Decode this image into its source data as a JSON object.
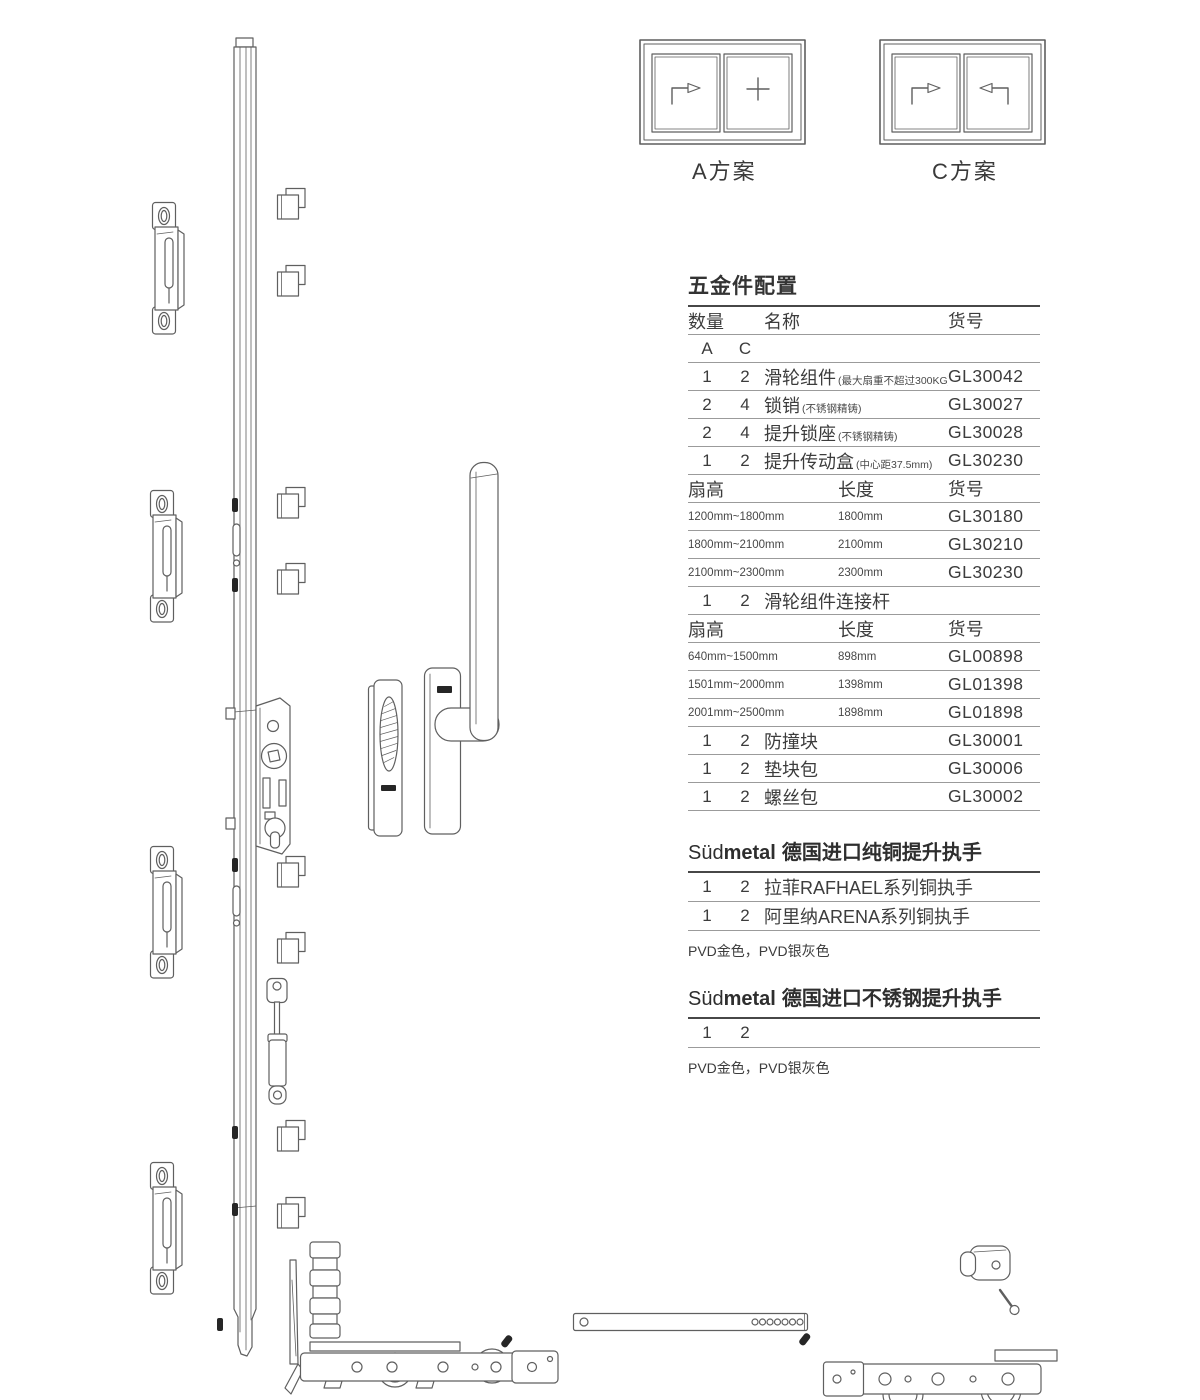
{
  "plans": {
    "a_label": "A方案",
    "c_label": "C方案"
  },
  "hardware_table": {
    "title": "五金件配置",
    "headers": {
      "qty": "数量",
      "name": "名称",
      "code": "货号"
    },
    "variant_a": "A",
    "variant_c": "C",
    "rows": [
      {
        "a": "1",
        "c": "2",
        "name": "滑轮组件",
        "note": "(最大扇重不超过300KG)",
        "code": "GL30042"
      },
      {
        "a": "2",
        "c": "4",
        "name": "锁销",
        "note": "(不锈钢精铸)",
        "code": "GL30027"
      },
      {
        "a": "2",
        "c": "4",
        "name": "提升锁座",
        "note": "(不锈钢精铸)",
        "code": "GL30028"
      },
      {
        "a": "1",
        "c": "2",
        "name": "提升传动盒",
        "note": "(中心距37.5mm)",
        "code": "GL30230"
      }
    ],
    "size_header_1": {
      "fan": "扇高",
      "len": "长度",
      "code": "货号"
    },
    "size_rows_1": [
      {
        "fan": "1200mm~1800mm",
        "len": "1800mm",
        "code": "GL30180"
      },
      {
        "fan": "1800mm~2100mm",
        "len": "2100mm",
        "code": "GL30210"
      },
      {
        "fan": "2100mm~2300mm",
        "len": "2300mm",
        "code": "GL30230"
      }
    ],
    "connector_row": {
      "a": "1",
      "c": "2",
      "name": "滑轮组件连接杆"
    },
    "size_header_2": {
      "fan": "扇高",
      "len": "长度",
      "code": "货号"
    },
    "size_rows_2": [
      {
        "fan": "640mm~1500mm",
        "len": "898mm",
        "code": "GL00898"
      },
      {
        "fan": "1501mm~2000mm",
        "len": "1398mm",
        "code": "GL01398"
      },
      {
        "fan": "2001mm~2500mm",
        "len": "1898mm",
        "code": "GL01898"
      }
    ],
    "tail_rows": [
      {
        "a": "1",
        "c": "2",
        "name": "防撞块",
        "code": "GL30001"
      },
      {
        "a": "1",
        "c": "2",
        "name": "垫块包",
        "code": "GL30006"
      },
      {
        "a": "1",
        "c": "2",
        "name": "螺丝包",
        "code": "GL30002"
      }
    ]
  },
  "brass_section": {
    "brand_sud": "Süd",
    "brand_metal": "metal",
    "title": "德国进口纯铜提升执手",
    "rows": [
      {
        "a": "1",
        "c": "2",
        "name": "拉菲RAFHAEL系列铜执手"
      },
      {
        "a": "1",
        "c": "2",
        "name": "阿里纳ARENA系列铜执手"
      }
    ],
    "note": "PVD金色，PVD银灰色"
  },
  "steel_section": {
    "brand_sud": "Süd",
    "brand_metal": "metal",
    "title": "德国进口不锈钢提升执手",
    "row": {
      "a": "1",
      "c": "2"
    },
    "note": "PVD金色，PVD银灰色"
  },
  "colors": {
    "line_art": "#5f5f5f",
    "table_rule": "#9b9b9b",
    "text": "#3c3c3c"
  }
}
